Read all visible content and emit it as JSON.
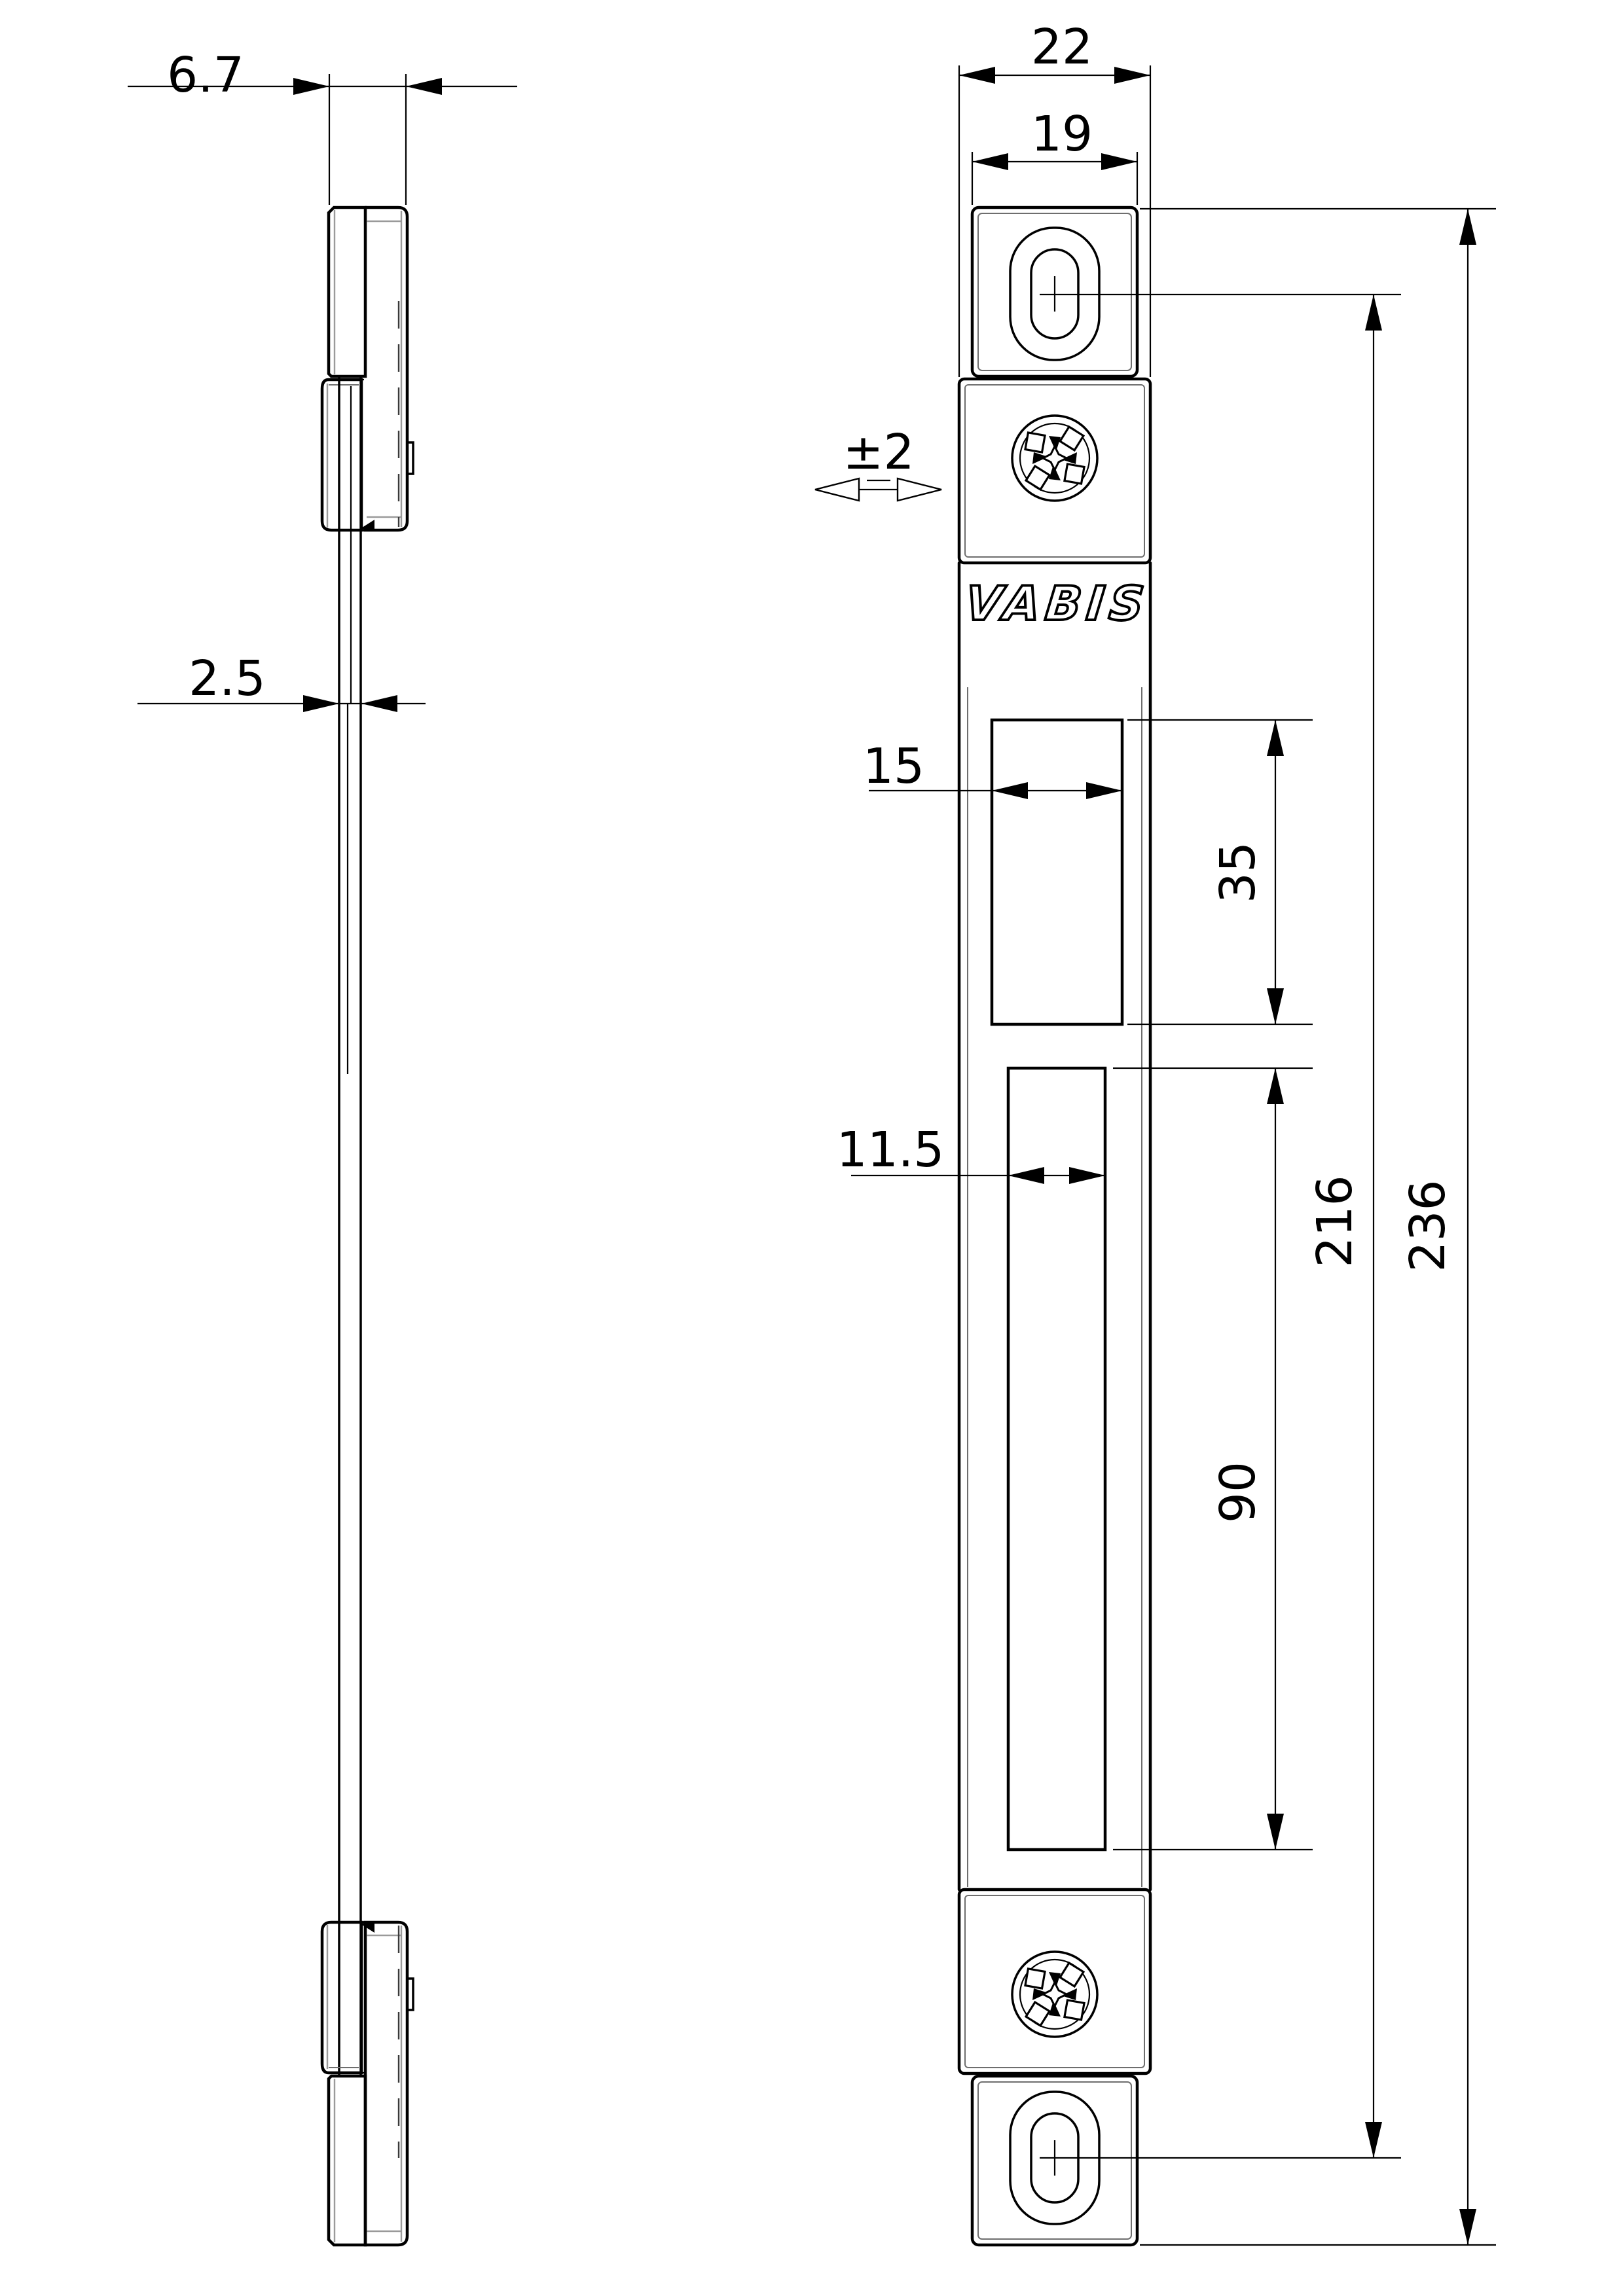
{
  "drawing": {
    "type": "technical-dimension-drawing",
    "brand": "VABIS",
    "views": [
      "side-profile",
      "front-face"
    ],
    "part": "strike-plate"
  },
  "labels": {
    "cap_depth": "6.7",
    "plate_thickness": "2.5",
    "overall_width": "22",
    "cap_width": "19",
    "lateral_tolerance": "±2",
    "latch_hole_width": "15",
    "latch_hole_height": "35",
    "bolt_hole_width": "11.5",
    "bolt_hole_height": "90",
    "slot_center_spacing": "216",
    "overall_length": "236",
    "brand": "VABIS"
  },
  "colors": {
    "line": "#000000",
    "construction": "#9a9a9a",
    "background": "#ffffff"
  }
}
